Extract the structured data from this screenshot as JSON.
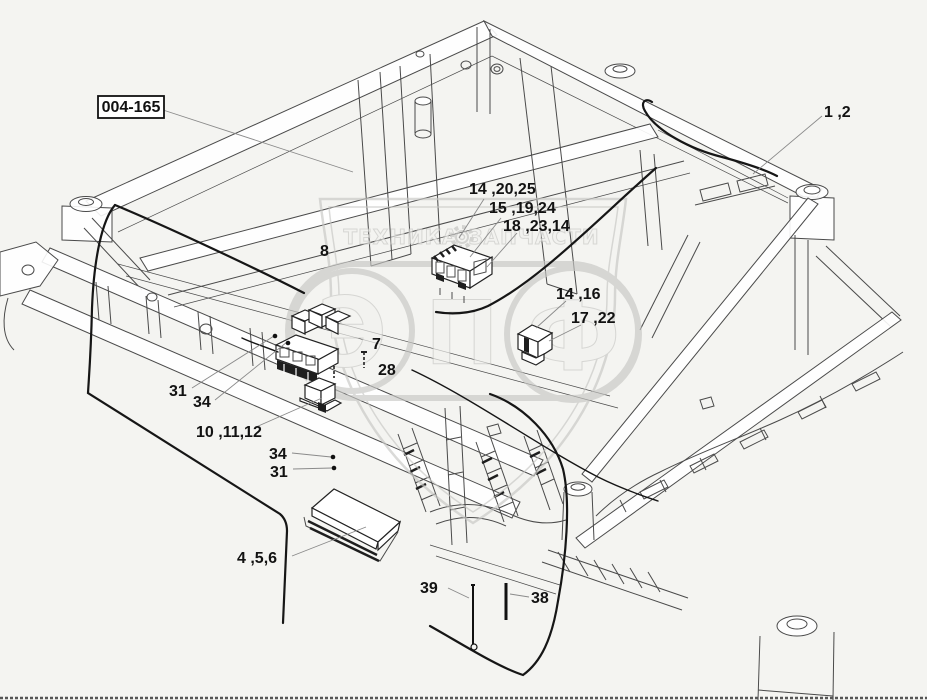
{
  "watermark": {
    "word_left": "ТЕХНИКА",
    "word_right": "ЗАПЧАСТИ",
    "letters": [
      "Э",
      "П",
      "Ф"
    ],
    "gear_icon": "gear"
  },
  "callouts": [
    {
      "label": "004-165"
    },
    {
      "label": "1 ,2"
    },
    {
      "label": "14 ,20,25"
    },
    {
      "label": "15 ,19,24"
    },
    {
      "label": "18 ,23,14"
    },
    {
      "label": "8"
    },
    {
      "label": "14 ,16"
    },
    {
      "label": "17 ,22"
    },
    {
      "label": "7"
    },
    {
      "label": "28"
    },
    {
      "label": "31"
    },
    {
      "label": "34"
    },
    {
      "label": "10 ,11,12"
    },
    {
      "label": "34"
    },
    {
      "label": "31"
    },
    {
      "label": "4 ,5,6"
    },
    {
      "label": "39"
    },
    {
      "label": "38"
    }
  ],
  "colors": {
    "bg": "#f4f4f1",
    "line": "#4a4a4a",
    "cable": "#161616",
    "leader": "#8a8a8a",
    "label": "#121212",
    "wm": "#c7c7c4"
  }
}
